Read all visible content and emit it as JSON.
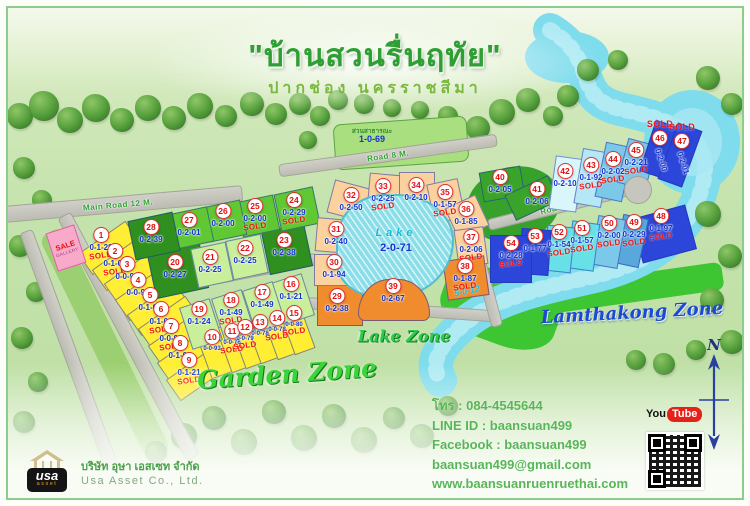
{
  "title": "\"บ้านสวนรื่นฤทัย\"",
  "subtitle": "ปากช่อง นครราชสีมา",
  "zones": {
    "garden": "Garden Zone",
    "lake": "Lake Zone",
    "lamthakong": "Lamthakong Zone"
  },
  "lake": {
    "label": "Lake",
    "size": "2-0-71"
  },
  "park": {
    "label": "สวนสาธารณะ",
    "size": "1-0-69"
  },
  "sale_gallery": {
    "line1": "SALE",
    "line2": "GALLERY"
  },
  "misc": {
    "canal_size": "5-0-12"
  },
  "labels": {
    "sold": "SOLD"
  },
  "compass": {
    "n": "N"
  },
  "contact": {
    "phone": "โทร : 084-4545644",
    "line_id": "LINE ID : baansuan499",
    "facebook": "Facebook : baansuan499",
    "email": "baansuan499@gmail.com",
    "website": "www.baansuanruenruethai.com"
  },
  "company": {
    "logo_main": "usa",
    "logo_sub": "asset",
    "name_th": "บริษัท อุษา เอสเซท จำกัด",
    "name_en": "Usa Asset Co., Ltd."
  },
  "youtube": {
    "part1": "You",
    "part2": "Tube"
  },
  "colors": {
    "y": "#ffee33",
    "lg": "#c9ef9b",
    "mg": "#5fc832",
    "dg": "#2f8f1f",
    "mg2": "#3aa32a",
    "po": "#fbd29d",
    "do": "#f08c2e",
    "cc0": "#d9f7fb",
    "cc2": "#b5e7f7",
    "cc3": "#7cc8e8",
    "cc4": "#58a8dc",
    "cc5": "#68e0e8",
    "dbl": "#2b46d8"
  },
  "roads": [
    {
      "x": 110,
      "y": 196,
      "len": 250,
      "wid": 17,
      "rot": -5,
      "label": "Main Road 12 M."
    },
    {
      "x": 120,
      "y": 328,
      "len": 275,
      "wid": 15,
      "rot": 62,
      "label": ""
    },
    {
      "x": 64,
      "y": 350,
      "len": 270,
      "wid": 14,
      "rot": 70,
      "label": ""
    },
    {
      "x": 231,
      "y": 266,
      "len": 160,
      "wid": 12,
      "rot": -11,
      "label": "Road 8 M."
    },
    {
      "x": 380,
      "y": 147,
      "len": 220,
      "wid": 13,
      "rot": -8,
      "label": "Road 8 M."
    },
    {
      "x": 382,
      "y": 301,
      "len": 205,
      "wid": 12,
      "rot": 4,
      "label": "Road 8 M."
    },
    {
      "x": 553,
      "y": 199,
      "len": 150,
      "wid": 12,
      "rot": -14,
      "label": "Road 8 M."
    },
    {
      "x": 474,
      "y": 263,
      "len": 115,
      "wid": 12,
      "rot": 75,
      "label": ""
    }
  ],
  "plots": [
    {
      "no": 1,
      "size": "0-1-28",
      "sold": true,
      "c": "y",
      "rect": [
        101,
        240,
        58,
        26,
        -35
      ],
      "lab": [
        93,
        219
      ]
    },
    {
      "no": 2,
      "size": "0-1-01",
      "sold": true,
      "c": "y",
      "rect": [
        115,
        256,
        58,
        26,
        -35
      ],
      "lab": [
        107,
        235
      ]
    },
    {
      "no": 3,
      "size": "0-0-95",
      "sold": false,
      "c": "y",
      "rect": [
        127,
        270,
        58,
        26,
        -35
      ],
      "lab": [
        119,
        248
      ]
    },
    {
      "no": 4,
      "size": "0-0-98",
      "sold": false,
      "c": "y",
      "rect": [
        138,
        286,
        58,
        26,
        -35
      ],
      "lab": [
        130,
        264
      ]
    },
    {
      "no": 5,
      "size": "0-1-00",
      "sold": false,
      "c": "y",
      "rect": [
        150,
        301,
        58,
        26,
        -35
      ],
      "lab": [
        142,
        279
      ]
    },
    {
      "no": 6,
      "size": "0-1-01",
      "sold": true,
      "c": "y",
      "rect": [
        161,
        315,
        58,
        26,
        -35
      ],
      "lab": [
        153,
        293
      ]
    },
    {
      "no": 7,
      "size": "0-0-94",
      "sold": true,
      "c": "y",
      "rect": [
        171,
        332,
        58,
        26,
        -35
      ],
      "lab": [
        163,
        310
      ]
    },
    {
      "no": 8,
      "size": "0-1-03",
      "sold": false,
      "c": "y",
      "rect": [
        180,
        349,
        58,
        26,
        -35
      ],
      "lab": [
        172,
        327
      ]
    },
    {
      "no": 9,
      "size": "0-1-21",
      "sold": true,
      "c": "y",
      "rect": [
        189,
        366,
        58,
        26,
        -35
      ],
      "lab": [
        181,
        344
      ]
    },
    {
      "no": 10,
      "size": "0-0-93",
      "sold": false,
      "c": "y",
      "rect": [
        206,
        345,
        22,
        48,
        -20
      ],
      "lab": [
        204,
        321
      ],
      "fs": 6
    },
    {
      "no": 11,
      "size": "0-0-76",
      "sold": true,
      "c": "y",
      "rect": [
        226,
        339,
        22,
        48,
        -20
      ],
      "lab": [
        224,
        315
      ],
      "fs": 6
    },
    {
      "no": 12,
      "size": "0-0-79",
      "sold": true,
      "c": "y",
      "rect": [
        240,
        335,
        22,
        48,
        -20
      ],
      "lab": [
        237,
        311
      ],
      "fs": 6
    },
    {
      "no": 13,
      "size": "0-0-78",
      "sold": false,
      "c": "y",
      "rect": [
        255,
        330,
        22,
        48,
        -20
      ],
      "lab": [
        252,
        306
      ],
      "fs": 6
    },
    {
      "no": 14,
      "size": "0-0-78",
      "sold": true,
      "c": "y",
      "rect": [
        272,
        326,
        22,
        48,
        -20
      ],
      "lab": [
        269,
        302
      ],
      "fs": 6
    },
    {
      "no": 15,
      "size": "0-0-80",
      "sold": true,
      "c": "y",
      "rect": [
        289,
        321,
        22,
        48,
        -20
      ],
      "lab": [
        286,
        297
      ],
      "fs": 6
    },
    {
      "no": 16,
      "size": "0-1-21",
      "sold": false,
      "c": "lg",
      "rect": [
        285,
        291,
        32,
        44,
        -18
      ],
      "lab": [
        283,
        268
      ]
    },
    {
      "no": 17,
      "size": "0-1-49",
      "sold": false,
      "c": "lg",
      "rect": [
        256,
        299,
        32,
        44,
        -18
      ],
      "lab": [
        254,
        276
      ]
    },
    {
      "no": 18,
      "size": "0-1-49",
      "sold": true,
      "c": "lg",
      "rect": [
        225,
        307,
        32,
        44,
        -18
      ],
      "lab": [
        223,
        284
      ]
    },
    {
      "no": 19,
      "size": "0-1-24",
      "sold": false,
      "c": "lg",
      "rect": [
        193,
        316,
        32,
        44,
        -18
      ],
      "lab": [
        191,
        293
      ]
    },
    {
      "no": 20,
      "size": "0-2-27",
      "sold": false,
      "c": "dg",
      "rect": [
        170,
        263,
        54,
        46,
        -12
      ],
      "lab": [
        167,
        246
      ]
    },
    {
      "no": 21,
      "size": "0-2-25",
      "sold": false,
      "c": "lg",
      "rect": [
        204,
        257,
        36,
        40,
        -12
      ],
      "lab": [
        202,
        241
      ]
    },
    {
      "no": 22,
      "size": "0-2-25",
      "sold": false,
      "c": "lg",
      "rect": [
        239,
        249,
        36,
        40,
        -12
      ],
      "lab": [
        237,
        232
      ]
    },
    {
      "no": 23,
      "size": "0-2-38",
      "sold": false,
      "c": "dg",
      "rect": [
        279,
        241,
        44,
        44,
        -12
      ],
      "lab": [
        276,
        224
      ]
    },
    {
      "no": 24,
      "size": "0-2-29",
      "sold": true,
      "c": "mg",
      "rect": [
        289,
        201,
        40,
        38,
        -12
      ],
      "lab": [
        286,
        184
      ]
    },
    {
      "no": 25,
      "size": "0-2-00",
      "sold": true,
      "c": "mg",
      "rect": [
        250,
        208,
        38,
        36,
        -12
      ],
      "lab": [
        247,
        190
      ]
    },
    {
      "no": 26,
      "size": "0-2-00",
      "sold": false,
      "c": "mg",
      "rect": [
        217,
        213,
        38,
        36,
        -12
      ],
      "lab": [
        215,
        195
      ]
    },
    {
      "no": 27,
      "size": "0-2-01",
      "sold": false,
      "c": "mg",
      "rect": [
        183,
        220,
        40,
        36,
        -12
      ],
      "lab": [
        181,
        204
      ]
    },
    {
      "no": 28,
      "size": "0-2-39",
      "sold": false,
      "c": "dg",
      "rect": [
        146,
        228,
        46,
        40,
        -12
      ],
      "lab": [
        143,
        211
      ]
    },
    {
      "no": 29,
      "size": "0-2-38",
      "sold": false,
      "c": "do",
      "rect": [
        332,
        297,
        46,
        42,
        0
      ],
      "lab": [
        329,
        280
      ]
    },
    {
      "no": 30,
      "size": "0-1-94",
      "sold": false,
      "c": "po",
      "rect": [
        328,
        262,
        44,
        32,
        0
      ],
      "lab": [
        326,
        246
      ]
    },
    {
      "no": 31,
      "size": "0-2-40",
      "sold": false,
      "c": "po",
      "rect": [
        330,
        228,
        44,
        34,
        5
      ],
      "lab": [
        328,
        213
      ]
    },
    {
      "no": 32,
      "size": "0-2-50",
      "sold": false,
      "c": "po",
      "rect": [
        346,
        194,
        48,
        34,
        15
      ],
      "lab": [
        343,
        179
      ]
    },
    {
      "no": 33,
      "size": "0-2-25",
      "sold": true,
      "c": "po",
      "rect": [
        377,
        187,
        34,
        42,
        5
      ],
      "lab": [
        375,
        170
      ]
    },
    {
      "no": 34,
      "size": "0-2-10",
      "sold": false,
      "c": "po",
      "rect": [
        409,
        185,
        36,
        42,
        0
      ],
      "lab": [
        408,
        169
      ]
    },
    {
      "no": 35,
      "size": "0-1-57",
      "sold": true,
      "c": "po",
      "rect": [
        438,
        193,
        32,
        40,
        -12
      ],
      "lab": [
        437,
        176
      ]
    },
    {
      "no": 36,
      "size": "0-1-85",
      "sold": false,
      "c": "po",
      "rect": [
        459,
        209,
        34,
        34,
        -25
      ],
      "lab": [
        458,
        193
      ]
    },
    {
      "no": 37,
      "size": "0-2-06",
      "sold": true,
      "c": "po",
      "rect": [
        463,
        239,
        30,
        38,
        -8
      ],
      "lab": [
        463,
        221
      ]
    },
    {
      "no": 38,
      "size": "0-1-87",
      "sold": true,
      "c": "do",
      "rect": [
        458,
        270,
        42,
        40,
        -8
      ],
      "lab": [
        457,
        250
      ]
    },
    {
      "no": 39,
      "size": "0-2-67",
      "sold": false,
      "c": "do",
      "rect": [
        386,
        292,
        72,
        42,
        0
      ],
      "lab": [
        385,
        270
      ],
      "arc": true
    },
    {
      "no": 40,
      "size": "0-2-05",
      "sold": false,
      "c": "mg2",
      "rect": [
        494,
        176,
        42,
        30,
        -10
      ],
      "lab": [
        492,
        161
      ]
    },
    {
      "no": 41,
      "size": "0-2-06",
      "sold": false,
      "c": "mg2",
      "rect": [
        524,
        190,
        48,
        28,
        -25
      ],
      "lab": [
        529,
        173
      ]
    },
    {
      "no": 42,
      "size": "0-2-10",
      "sold": false,
      "c": "cc0",
      "rect": [
        558,
        176,
        28,
        54,
        8
      ],
      "lab": [
        557,
        155
      ]
    },
    {
      "no": 43,
      "size": "0-1-92",
      "sold": true,
      "c": "cc2",
      "rect": [
        584,
        170,
        28,
        56,
        10
      ],
      "lab": [
        583,
        149
      ]
    },
    {
      "no": 44,
      "size": "0-2-02",
      "sold": true,
      "c": "cc3",
      "rect": [
        606,
        164,
        28,
        56,
        12
      ],
      "lab": [
        605,
        143
      ]
    },
    {
      "no": 45,
      "size": "0-2-21",
      "sold": true,
      "c": "cc3",
      "rect": [
        629,
        156,
        30,
        46,
        15
      ],
      "lab": [
        628,
        134
      ]
    },
    {
      "no": 46,
      "size": "0-2-00",
      "sold": true,
      "c": "dbl",
      "rect": [
        651,
        141,
        24,
        54,
        18
      ],
      "lab": [
        652,
        112
      ],
      "soldFirst": true,
      "sizeRot": true
    },
    {
      "no": 47,
      "size": "0-2-01",
      "sold": true,
      "c": "dbl",
      "rect": [
        672,
        147,
        26,
        60,
        20
      ],
      "lab": [
        674,
        115
      ],
      "soldFirst": true,
      "sizeRot": true
    },
    {
      "no": 48,
      "size": "0-1-97",
      "sold": true,
      "c": "dbl",
      "rect": [
        656,
        226,
        56,
        46,
        -15
      ],
      "lab": [
        653,
        200
      ]
    },
    {
      "no": 49,
      "size": "0-2-29",
      "sold": true,
      "c": "cc4",
      "rect": [
        623,
        233,
        26,
        50,
        12
      ],
      "lab": [
        626,
        206
      ]
    },
    {
      "no": 50,
      "size": "0-2-00",
      "sold": true,
      "c": "cc3",
      "rect": [
        600,
        234,
        28,
        50,
        10
      ],
      "lab": [
        601,
        207
      ]
    },
    {
      "no": 51,
      "size": "0-1-57",
      "sold": true,
      "c": "cc5",
      "rect": [
        575,
        238,
        28,
        48,
        8
      ],
      "lab": [
        574,
        212
      ]
    },
    {
      "no": 52,
      "size": "0-1-54",
      "sold": true,
      "c": "cc5",
      "rect": [
        551,
        241,
        28,
        46,
        6
      ],
      "lab": [
        551,
        216
      ]
    },
    {
      "no": 53,
      "size": "0-1-77",
      "sold": false,
      "c": "dbl",
      "rect": [
        527,
        244,
        30,
        46,
        4
      ],
      "lab": [
        527,
        220
      ]
    },
    {
      "no": 54,
      "size": "0-2-28",
      "sold": true,
      "c": "dbl",
      "rect": [
        503,
        251,
        42,
        48,
        0
      ],
      "lab": [
        503,
        227
      ]
    }
  ]
}
